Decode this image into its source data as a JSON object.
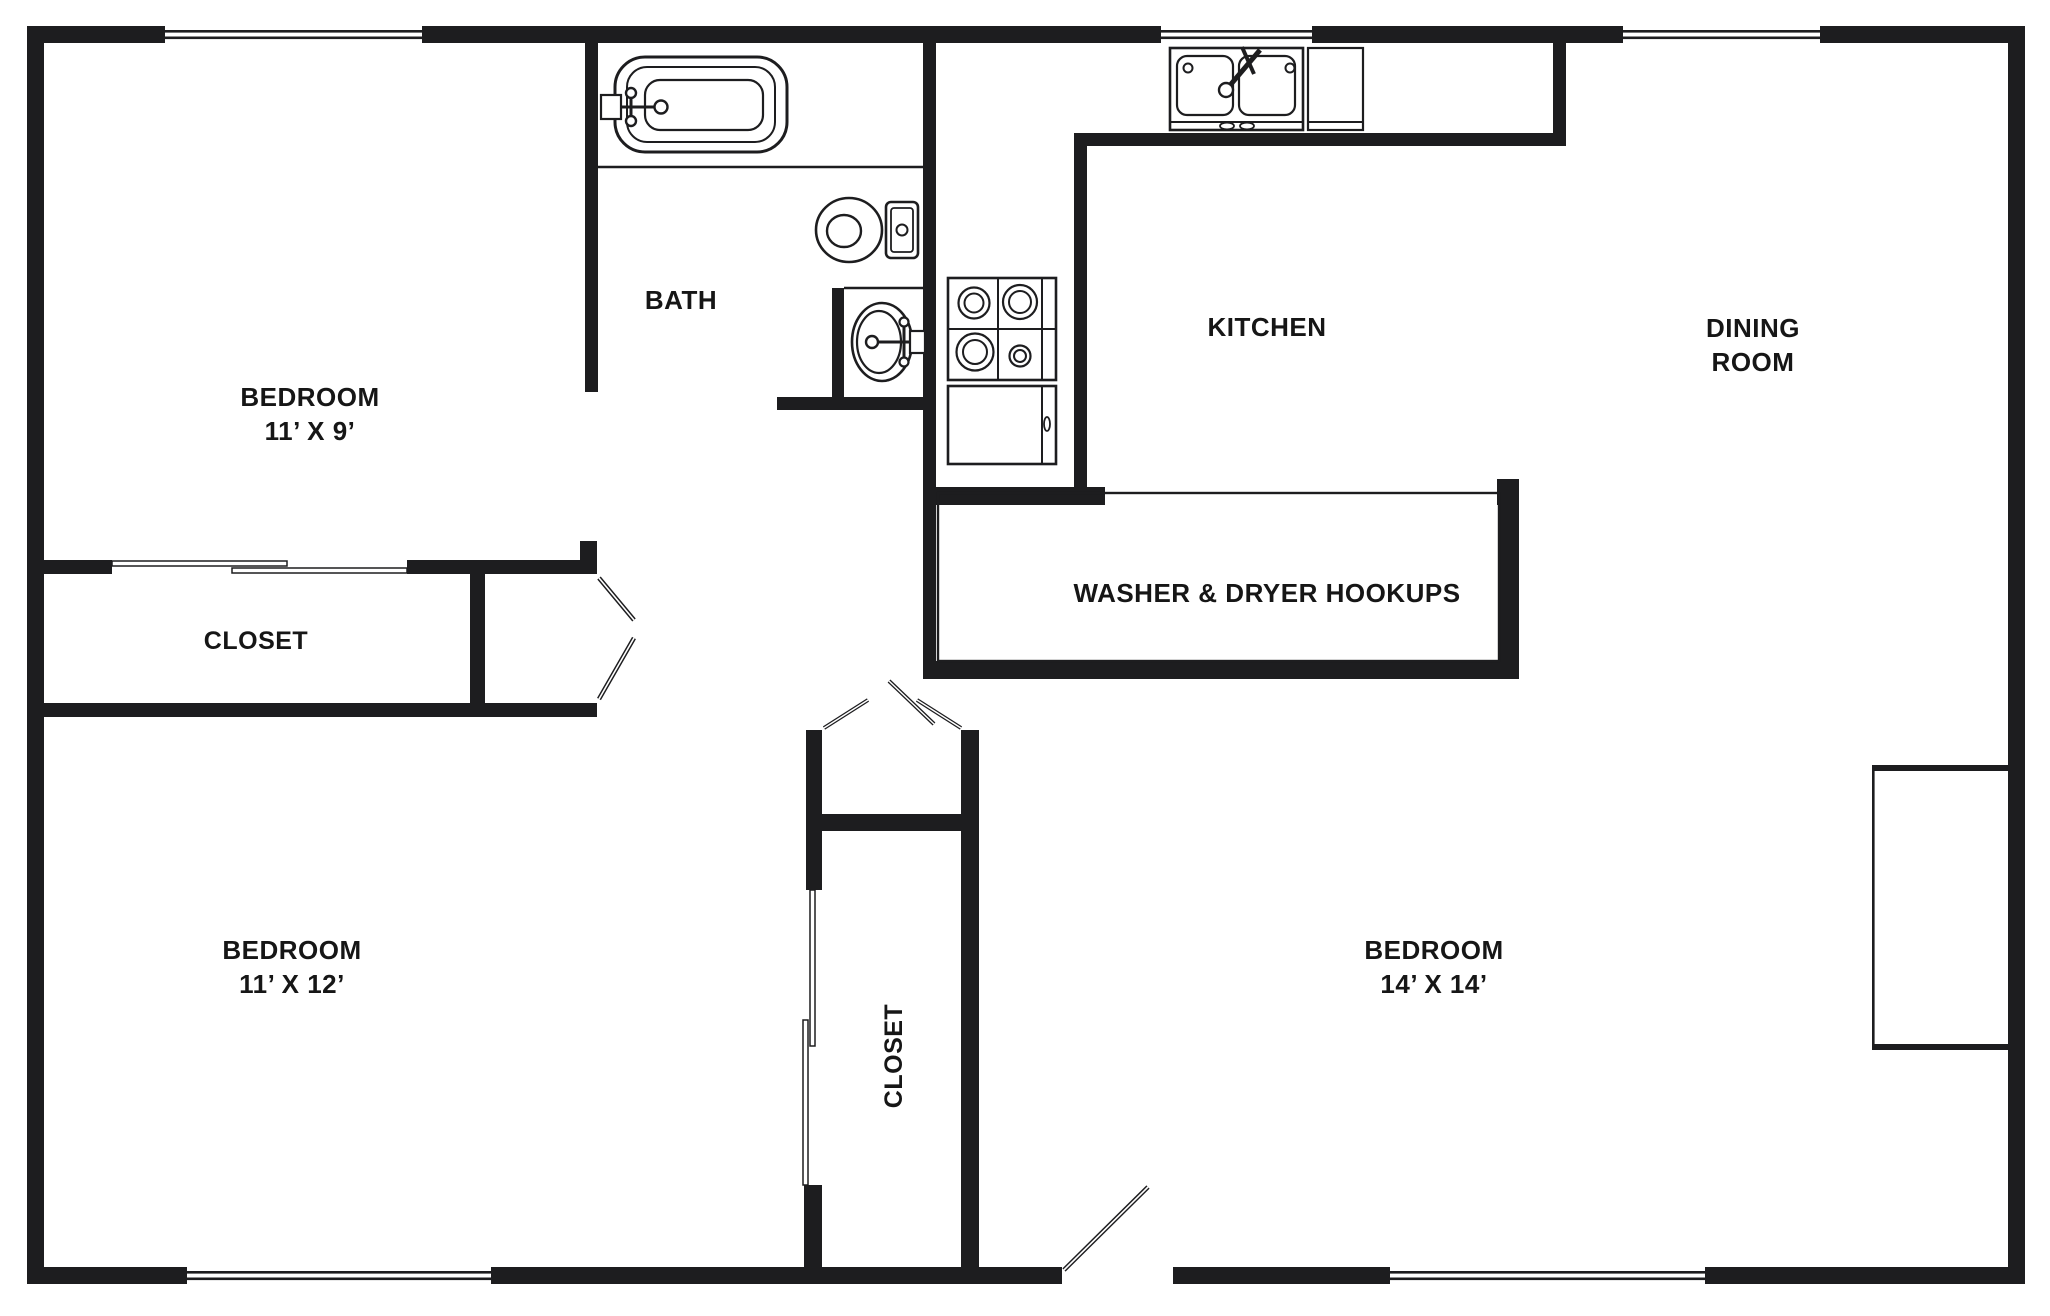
{
  "plan_title": "2 Bedroom Apartment Floor Plan",
  "rooms": {
    "bedroom_top_left": {
      "lines": [
        "BEDROOM",
        "11’ X 9’"
      ]
    },
    "bath": {
      "label": "BATH"
    },
    "kitchen": {
      "label": "KITCHEN"
    },
    "dining": {
      "lines": [
        "DINING",
        "ROOM"
      ]
    },
    "laundry": {
      "label": "WASHER & DRYER HOOKUPS"
    },
    "hall_closet": {
      "label": "CLOSET"
    },
    "bedroom_bottom_left": {
      "lines": [
        "BEDROOM",
        "11’ X 12’"
      ]
    },
    "bedroom_closet": {
      "label": "CLOSET"
    },
    "bedroom_bottom_right": {
      "lines": [
        "BEDROOM",
        "14’ X 14’"
      ]
    }
  },
  "fixtures": [
    "bathtub-icon",
    "toilet-icon",
    "bathroom-sink-icon",
    "kitchen-double-sink-icon",
    "kitchen-counter-icon",
    "stove-icon",
    "refrigerator-icon",
    "built-in-wardrobe-icon"
  ],
  "colors": {
    "wall": "#1d1d1f",
    "line": "#1d1d1f",
    "background": "#ffffff",
    "text": "#161616"
  }
}
